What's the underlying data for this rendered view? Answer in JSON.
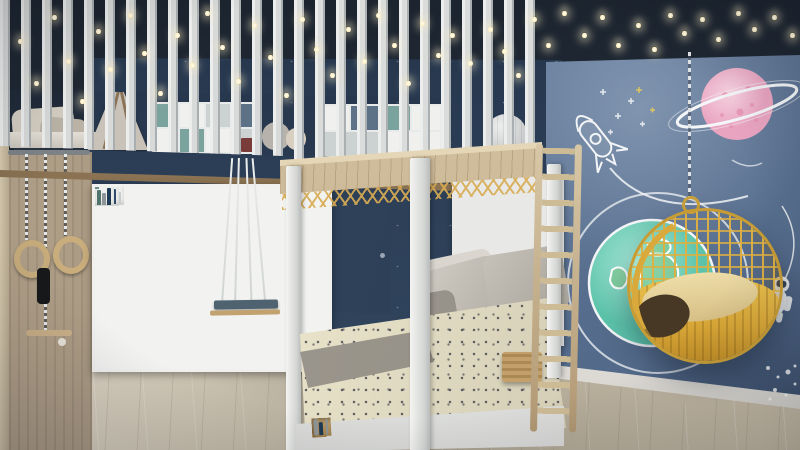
{
  "scene": {
    "description": "3D render of a space-themed kids bedroom: loft with slat railing and teepee under falling-star fairy lights, mosaic bookshelf wall with indoor swing and gym rings, white four-poster bed with slat canopy, wooden ladder, and a blue mural wall with rocket, pink ringed planet, Earth globe, astronaut and a hanging yellow rattan egg chair",
    "objects": [
      "ceiling-fairy-lights",
      "loft-railing",
      "loft-teepee",
      "loft-cushions",
      "plush-toys",
      "wood-beam",
      "bookshelf-wall",
      "cabinet-doors",
      "indoor-swing",
      "gym-rings",
      "gym-grip",
      "trapeze-bar",
      "door",
      "four-poster-bed",
      "canopy-slats",
      "gold-lattice",
      "paper-lantern",
      "headboard-shelves",
      "pillows",
      "polka-dot-duvet",
      "gray-blanket",
      "under-bed-storage",
      "wood-ladder",
      "storage-basket",
      "egg-hanging-chair",
      "hanging-chain",
      "earth-globe-mural",
      "saturn-planet-mural",
      "rocket-doodle",
      "star-doodles",
      "astronaut-figure",
      "orbit-lines",
      "star-cluster",
      "wood-floor"
    ]
  },
  "palette": {
    "ceiling": "#232d3b",
    "back_wall": "#2d4058",
    "mural_wall": "#5f7696",
    "slats": "#eceded",
    "beam_wood": "#c3ae88",
    "floor_wood": "#d2c9b6",
    "cabinet_wood": "#8f6f48",
    "duvet": "#ebe5cc",
    "pillow_gray": "#b2aea6",
    "chair_gold": "#d8a737",
    "earth_teal": "#6fcdb4",
    "planet_pink": "#f0bcd1",
    "doodle_white": "#f2f4f6",
    "swing_seat": "#4f6270",
    "teal_cell": "#7ba39e",
    "slate_cell": "#5d7187",
    "navy_cell": "#3c5270",
    "book_spines": [
      "#31496b",
      "#c7ccce",
      "#6f9188",
      "#2f4a66",
      "#d9d4c9",
      "#52746f",
      "#8d9598",
      "#1f3a54",
      "#b8b29f"
    ]
  },
  "ceiling_lights": [
    [
      18,
      38
    ],
    [
      34,
      80
    ],
    [
      52,
      14
    ],
    [
      66,
      58
    ],
    [
      80,
      98
    ],
    [
      96,
      28
    ],
    [
      108,
      66
    ],
    [
      128,
      12
    ],
    [
      142,
      50
    ],
    [
      158,
      90
    ],
    [
      175,
      32
    ],
    [
      190,
      62
    ],
    [
      205,
      10
    ],
    [
      220,
      44
    ],
    [
      236,
      78
    ],
    [
      252,
      22
    ],
    [
      268,
      54
    ],
    [
      284,
      92
    ],
    [
      300,
      16
    ],
    [
      314,
      46
    ],
    [
      330,
      72
    ],
    [
      346,
      26
    ],
    [
      362,
      58
    ],
    [
      376,
      12
    ],
    [
      392,
      42
    ],
    [
      406,
      80
    ],
    [
      420,
      20
    ],
    [
      436,
      52
    ],
    [
      450,
      32
    ],
    [
      468,
      60
    ],
    [
      488,
      26
    ],
    [
      502,
      48
    ],
    [
      516,
      72
    ],
    [
      532,
      16
    ],
    [
      546,
      42
    ],
    [
      562,
      10
    ],
    [
      582,
      32
    ],
    [
      600,
      14
    ],
    [
      616,
      42
    ],
    [
      636,
      22
    ],
    [
      652,
      46
    ],
    [
      668,
      12
    ],
    [
      682,
      30
    ],
    [
      700,
      16
    ],
    [
      716,
      36
    ],
    [
      736,
      10
    ],
    [
      752,
      26
    ],
    [
      772,
      14
    ],
    [
      790,
      32
    ]
  ],
  "bookshelf": {
    "rows": [
      {
        "h": 24,
        "cells": [
          {
            "w": 2,
            "c": "W",
            "b": 3
          },
          {
            "w": 1,
            "c": "G",
            "b": 0
          },
          {
            "w": 1,
            "c": "T",
            "b": 0
          },
          {
            "w": 2,
            "c": "W",
            "b": 2
          },
          {
            "w": 1,
            "c": "S",
            "b": 0
          },
          {
            "w": 1,
            "c": "W",
            "b": 1
          },
          {
            "w": 2,
            "c": "G",
            "b": 0
          },
          {
            "w": 1,
            "c": "W",
            "b": 2
          },
          {
            "w": 1,
            "c": "T",
            "b": 0
          }
        ]
      },
      {
        "h": 24,
        "cells": [
          {
            "w": 1,
            "c": "W",
            "b": 4
          },
          {
            "w": 1,
            "c": "D",
            "b": 0
          },
          {
            "w": 1,
            "c": "S",
            "b": 0
          },
          {
            "w": 2,
            "c": "W",
            "b": 3
          },
          {
            "w": 1,
            "c": "T",
            "b": 0
          },
          {
            "w": 1,
            "c": "W",
            "b": 2
          },
          {
            "w": 1,
            "c": "G",
            "b": 0
          },
          {
            "w": 1,
            "c": "N",
            "b": 0
          },
          {
            "w": 2,
            "c": "W",
            "b": 3
          }
        ]
      },
      {
        "h": 24,
        "cells": [
          {
            "w": 1,
            "c": "G",
            "b": 0
          },
          {
            "w": 2,
            "c": "W",
            "b": 3
          },
          {
            "w": 1,
            "c": "N",
            "b": 0
          },
          {
            "w": 1,
            "c": "T",
            "b": 0
          },
          {
            "w": 2,
            "c": "W",
            "b": 4
          },
          {
            "w": 1,
            "c": "S",
            "b": 0
          },
          {
            "w": 1,
            "c": "W",
            "b": 2
          },
          {
            "w": 1,
            "c": "G",
            "b": 0
          }
        ]
      },
      {
        "h": 26,
        "cells": [
          {
            "w": 1,
            "c": "W",
            "b": 2
          },
          {
            "w": 1,
            "c": "N",
            "b": 0
          },
          {
            "w": 2,
            "c": "W",
            "b": 3
          },
          {
            "w": 1,
            "c": "D",
            "b": 0
          },
          {
            "w": 1,
            "c": "G",
            "b": 0
          },
          {
            "w": 2,
            "c": "W",
            "b": 3
          },
          {
            "w": 1,
            "c": "T",
            "b": 0
          },
          {
            "w": 1,
            "c": "S",
            "b": 0
          }
        ]
      },
      {
        "h": 26,
        "cells": [
          {
            "w": 2,
            "c": "W",
            "b": 5
          },
          {
            "w": 1,
            "c": "W",
            "b": 2
          },
          {
            "w": 1,
            "c": "G",
            "b": 0
          },
          {
            "w": 2,
            "c": "W",
            "b": 4
          },
          {
            "w": 1,
            "c": "S",
            "b": 0
          },
          {
            "w": 1,
            "c": "W",
            "b": 3
          },
          {
            "w": 1,
            "c": "T",
            "b": 0
          }
        ]
      }
    ],
    "cabinet_doors": 6
  },
  "loft": {
    "shelf_a": [
      "T",
      "W",
      "G",
      "S",
      "W",
      "T",
      "W",
      "G"
    ],
    "shelf_b": [
      "W",
      "S",
      "T",
      "W",
      "G",
      "W"
    ]
  },
  "bed": {
    "underbed_books": [
      2,
      0,
      3,
      0,
      2
    ]
  },
  "swing": {
    "ropes": 4
  },
  "gym": {
    "rings": 2
  }
}
